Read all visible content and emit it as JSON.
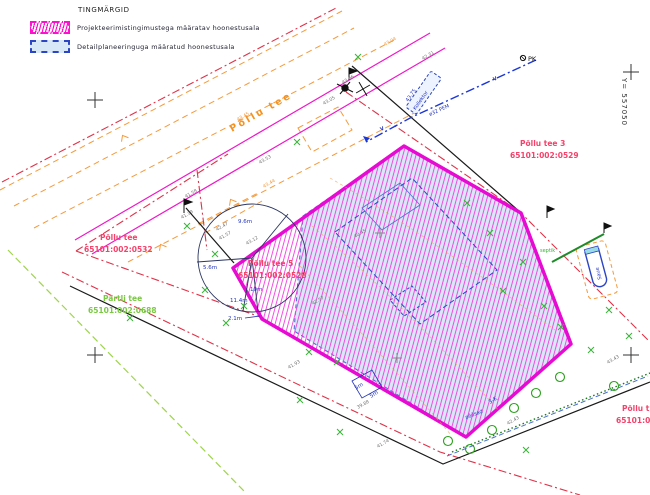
{
  "legend": {
    "title": "TINGMÄRGID",
    "items": [
      {
        "label": "Projekteerimistingimustega määratav hoonestusala",
        "swatch": "magenta-hatch",
        "color": "#ff10d0"
      },
      {
        "label": "Detailplaneeringuga määratud hoonestusala",
        "swatch": "blue-dashed",
        "color": "#2b45c5"
      }
    ]
  },
  "grid": {
    "y_coordinate_label": "Y= 557050"
  },
  "parcels": {
    "pollu_tee_3": {
      "name": "Põllu tee 3",
      "code": "65101:002:0529"
    },
    "pollu_tee": {
      "name": "Põllu tee",
      "code": "65101:002:0532"
    },
    "pollu_tee_5": {
      "name": "Põllu tee 5",
      "code": "65101:002:0528"
    },
    "partli_tee": {
      "name": "Pärtli tee",
      "code": "65101:002:0688"
    },
    "pollu_t_edge": {
      "name": "Põllu t",
      "code": "65101:00"
    }
  },
  "road": {
    "name": "Põllu tee"
  },
  "utilities": {
    "pk_label": "PK",
    "water_label_1": "V",
    "water_label_2": "V",
    "pipe_spec": "ø32 PEM",
    "collector_label": "Kollektor",
    "collector_elevation": "43.75",
    "septic_label": "septik",
    "well_label": "Saue",
    "hedge_label": "põõsad"
  },
  "dimensions": [
    {
      "text": "9.6m"
    },
    {
      "text": "5.6m"
    },
    {
      "text": "11.4m"
    },
    {
      "text": "10m"
    },
    {
      "text": "2.1m"
    },
    {
      "text": "5m"
    },
    {
      "text": "5m"
    },
    {
      "text": "3-K"
    }
  ],
  "elevations": [
    {
      "text": "43.04"
    },
    {
      "text": "42.31"
    },
    {
      "text": "43.06"
    },
    {
      "text": "43.05"
    },
    {
      "text": "43.45"
    },
    {
      "text": "43.53"
    },
    {
      "text": "41.58"
    },
    {
      "text": "41.39"
    },
    {
      "text": "42.47"
    },
    {
      "text": "41.57"
    },
    {
      "text": "43.12"
    },
    {
      "text": "40.45"
    },
    {
      "text": "41.93"
    },
    {
      "text": "42.57"
    },
    {
      "text": "39.88"
    },
    {
      "text": "41.74"
    },
    {
      "text": "42.43"
    },
    {
      "text": "43.43"
    },
    {
      "text": "43.44"
    }
  ],
  "colors": {
    "boundary_magenta": "#e60ad2",
    "hatch_magenta": "#f23ae0",
    "planned_area_blue_fill": "#d8e8f6",
    "planned_area_blue_border": "#2b45c5",
    "cadastral_red": "#e03248",
    "road_orange": "#f59a3c",
    "utility_blue": "#1a35d8",
    "vegetation_green": "#35b535"
  }
}
